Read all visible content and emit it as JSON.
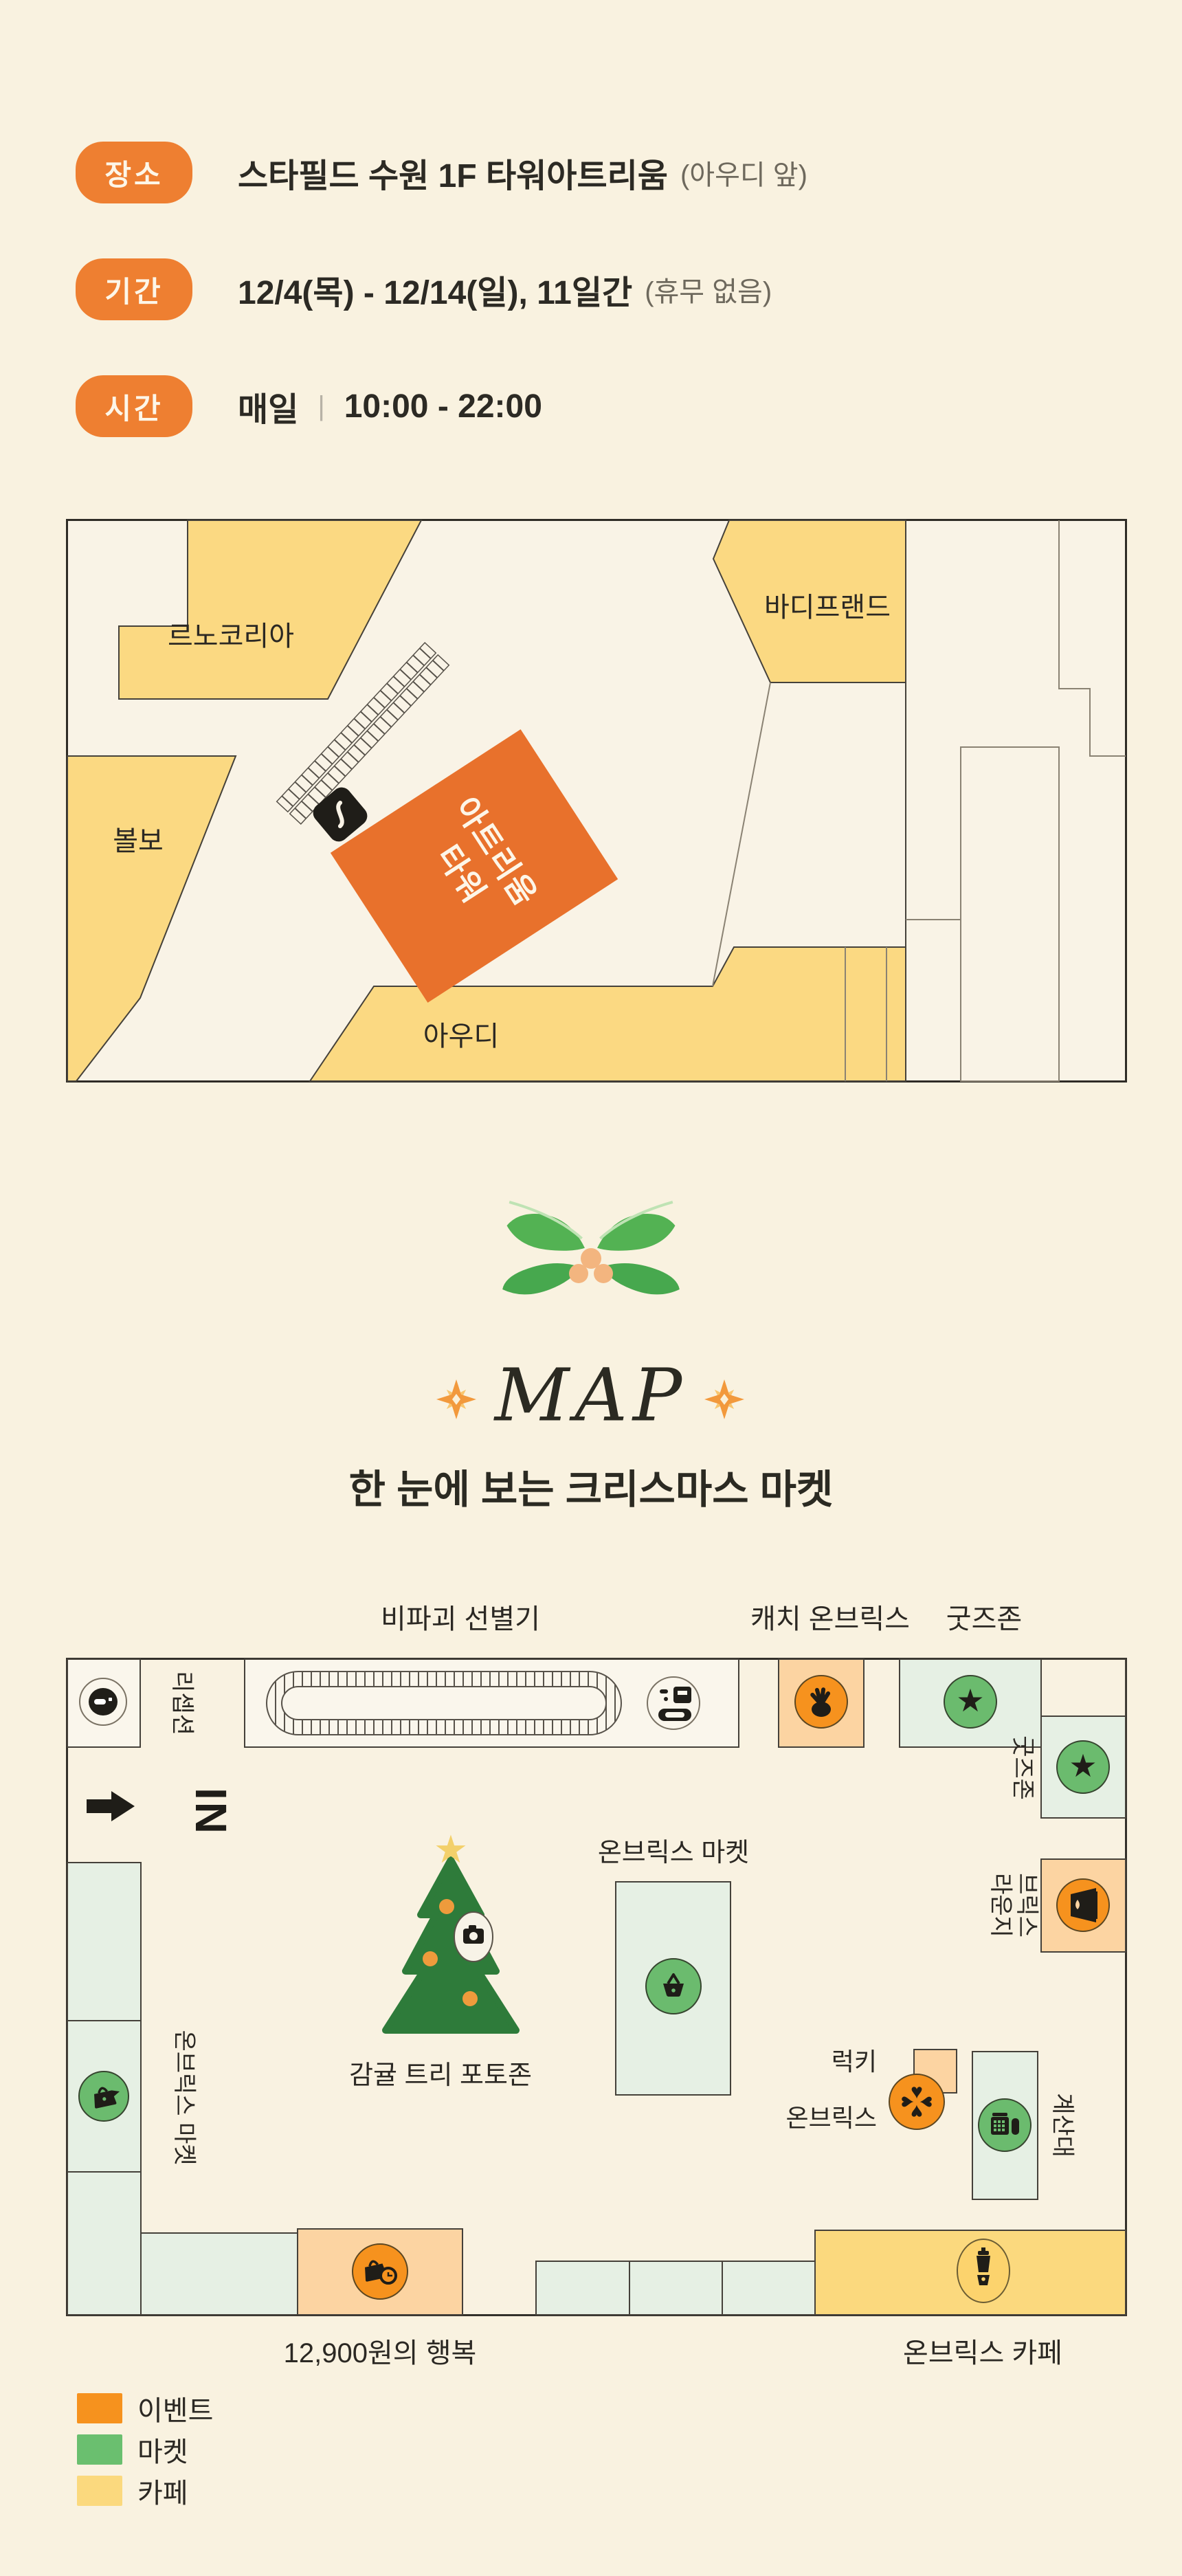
{
  "info": {
    "rows": [
      {
        "badge": "장소",
        "text": "스타필드 수원 1F 타워아트리움",
        "note": "(아우디 앞)"
      },
      {
        "badge": "기간",
        "text": "12/4(목) - 12/14(일), 11일간",
        "note": "(휴무 없음)"
      },
      {
        "badge": "시간",
        "text": "매일",
        "divider": "|",
        "time": "10:00 - 22:00"
      }
    ]
  },
  "floor_map": {
    "stores": {
      "renault": "르노코리아",
      "bodyfriend": "바디프랜드",
      "volvo": "볼보",
      "audi": "아우디"
    },
    "tower": {
      "line1": "타워",
      "line2": "아트리움"
    }
  },
  "map_heading": {
    "title": "MAP",
    "subtitle": "한 눈에 보는 크리스마스 마켓"
  },
  "market_map": {
    "top_labels": {
      "sorter": "비파괴 선별기",
      "catch": "캐치 온브릭스",
      "goods": "굿즈존"
    },
    "zones": {
      "reception": "리셉션",
      "entrance": "IN",
      "goods_side": "굿즈존",
      "lounge_line1": "브릭스",
      "lounge_line2": "라운지",
      "checkout": "계산대",
      "lucky_line1": "럭키",
      "lucky_line2": "온브릭스",
      "market_left": "온브릭스 마켓",
      "market_center": "온브릭스 마켓",
      "tree": "감귤 트리 포토존"
    },
    "bottom_labels": {
      "happiness": "12,900원의 행복",
      "cafe": "온브릭스 카페"
    }
  },
  "legend": {
    "items": [
      {
        "label": "이벤트",
        "color": "#f6921e"
      },
      {
        "label": "마켓",
        "color": "#6abf6f"
      },
      {
        "label": "카페",
        "color": "#fbd97e"
      }
    ]
  },
  "colors": {
    "page_bg": "#f9f2e0",
    "badge_orange": "#ee7f31",
    "store_yellow": "#fbd982",
    "tower_orange": "#e8712c",
    "event_orange": "#f6921e",
    "event_peach": "#fcd4a2",
    "market_green": "#6bbb6e",
    "market_green_light": "#e6f0e4",
    "cafe_yellow": "#fbd97e",
    "tree_green": "#2e7b3a",
    "text_dark": "#2b2823"
  },
  "icons": {
    "star": "★",
    "heart": "♥"
  }
}
